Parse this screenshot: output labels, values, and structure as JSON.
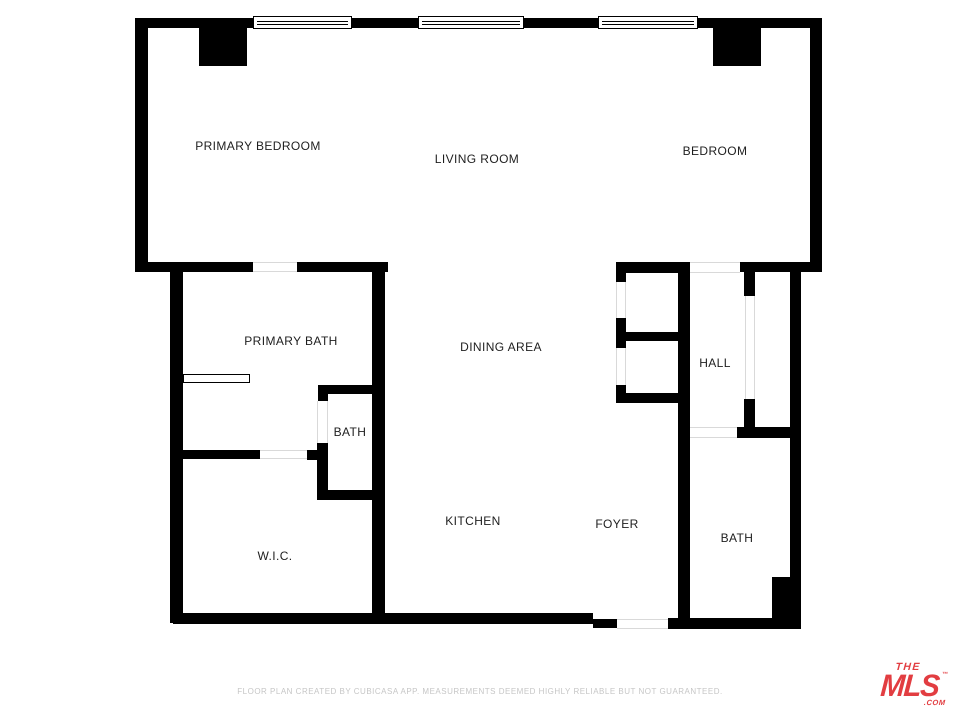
{
  "floor_plan": {
    "wall_color": "#000000",
    "label_color": "#1e1e1e",
    "opening_line_color": "#d9d9d9",
    "rooms": [
      {
        "name": "PRIMARY BEDROOM",
        "x": 258,
        "y": 146
      },
      {
        "name": "LIVING ROOM",
        "x": 477,
        "y": 159
      },
      {
        "name": "BEDROOM",
        "x": 715,
        "y": 151
      },
      {
        "name": "PRIMARY BATH",
        "x": 291,
        "y": 341
      },
      {
        "name": "DINING AREA",
        "x": 501,
        "y": 347
      },
      {
        "name": "HALL",
        "x": 715,
        "y": 363
      },
      {
        "name": "BATH",
        "x": 350,
        "y": 432
      },
      {
        "name": "W.I.C.",
        "x": 275,
        "y": 556
      },
      {
        "name": "KITCHEN",
        "x": 473,
        "y": 521
      },
      {
        "name": "FOYER",
        "x": 617,
        "y": 524
      },
      {
        "name": "BATH",
        "x": 737,
        "y": 538
      }
    ],
    "walls": [
      {
        "name": "top-wall-seg1",
        "x": 135,
        "y": 18,
        "w": 118,
        "h": 10
      },
      {
        "name": "top-wall-seg2",
        "x": 352,
        "y": 18,
        "w": 66,
        "h": 10
      },
      {
        "name": "top-wall-seg3",
        "x": 524,
        "y": 18,
        "w": 74,
        "h": 10
      },
      {
        "name": "top-wall-seg4",
        "x": 698,
        "y": 18,
        "w": 124,
        "h": 10
      },
      {
        "name": "left-outer-wall",
        "x": 135,
        "y": 18,
        "w": 13,
        "h": 254
      },
      {
        "name": "right-outer-wall",
        "x": 810,
        "y": 18,
        "w": 12,
        "h": 253
      },
      {
        "name": "pillar-primary-bedroom",
        "x": 199,
        "y": 28,
        "w": 48,
        "h": 38
      },
      {
        "name": "pillar-bedroom",
        "x": 713,
        "y": 28,
        "w": 48,
        "h": 38
      },
      {
        "name": "primary-bath-top-seg1",
        "x": 135,
        "y": 262,
        "w": 118,
        "h": 10
      },
      {
        "name": "primary-bath-top-seg2",
        "x": 297,
        "y": 262,
        "w": 91,
        "h": 10
      },
      {
        "name": "closet-top-wall",
        "x": 616,
        "y": 262,
        "w": 74,
        "h": 11
      },
      {
        "name": "bedroom-bottom-wall",
        "x": 740,
        "y": 262,
        "w": 82,
        "h": 10
      },
      {
        "name": "wic-left-wall",
        "x": 170,
        "y": 262,
        "w": 13,
        "h": 361
      },
      {
        "name": "central-vertical-wall",
        "x": 372,
        "y": 262,
        "w": 13,
        "h": 361
      },
      {
        "name": "mid-vertical-wall",
        "x": 678,
        "y": 262,
        "w": 12,
        "h": 361
      },
      {
        "name": "inner-right-wall",
        "x": 790,
        "y": 262,
        "w": 11,
        "h": 367
      },
      {
        "name": "primary-bath-bottom-seg",
        "x": 183,
        "y": 450,
        "w": 77,
        "h": 9
      },
      {
        "name": "primary-bath-bottom-stub",
        "x": 307,
        "y": 450,
        "w": 21,
        "h": 10
      },
      {
        "name": "small-bath-top-wall",
        "x": 318,
        "y": 385,
        "w": 67,
        "h": 9
      },
      {
        "name": "small-bath-top-jamb",
        "x": 318,
        "y": 385,
        "w": 10,
        "h": 16
      },
      {
        "name": "small-bath-left-wall",
        "x": 317,
        "y": 443,
        "w": 11,
        "h": 57
      },
      {
        "name": "small-bath-bottom-wall",
        "x": 317,
        "y": 490,
        "w": 68,
        "h": 10
      },
      {
        "name": "closet-left-seg1",
        "x": 616,
        "y": 262,
        "w": 10,
        "h": 20
      },
      {
        "name": "closet-left-seg2",
        "x": 616,
        "y": 318,
        "w": 10,
        "h": 30
      },
      {
        "name": "closet-left-seg3",
        "x": 616,
        "y": 385,
        "w": 10,
        "h": 18
      },
      {
        "name": "closet-divider-wall",
        "x": 620,
        "y": 332,
        "w": 70,
        "h": 9
      },
      {
        "name": "closet-bottom-wall",
        "x": 616,
        "y": 393,
        "w": 62,
        "h": 10
      },
      {
        "name": "hall-jamb-top",
        "x": 744,
        "y": 262,
        "w": 11,
        "h": 34
      },
      {
        "name": "hall-jamb-bottom",
        "x": 744,
        "y": 399,
        "w": 11,
        "h": 31
      },
      {
        "name": "bath-top-wall",
        "x": 737,
        "y": 427,
        "w": 64,
        "h": 11
      },
      {
        "name": "bottom-wall-left",
        "x": 173,
        "y": 613,
        "w": 420,
        "h": 11
      },
      {
        "name": "bottom-wall-step",
        "x": 593,
        "y": 619,
        "w": 24,
        "h": 9
      },
      {
        "name": "bottom-wall-right",
        "x": 668,
        "y": 618,
        "w": 133,
        "h": 11
      },
      {
        "name": "bath-plumbing-block",
        "x": 772,
        "y": 577,
        "w": 18,
        "h": 52
      }
    ],
    "windows": [
      {
        "name": "window-primary-bedroom",
        "x": 253,
        "y": 16,
        "w": 99,
        "h": 13
      },
      {
        "name": "window-living-room",
        "x": 418,
        "y": 16,
        "w": 106,
        "h": 13
      },
      {
        "name": "window-bedroom",
        "x": 598,
        "y": 16,
        "w": 100,
        "h": 13
      }
    ],
    "openings": [
      {
        "name": "door-primary-bath",
        "dir": "h",
        "x": 253,
        "y": 262,
        "w": 44,
        "h": 10
      },
      {
        "name": "door-wic",
        "dir": "h",
        "x": 260,
        "y": 450,
        "w": 47,
        "h": 9
      },
      {
        "name": "door-small-bath",
        "dir": "v",
        "x": 317,
        "y": 401,
        "w": 11,
        "h": 42
      },
      {
        "name": "door-closet-upper",
        "dir": "v",
        "x": 616,
        "y": 282,
        "w": 10,
        "h": 36
      },
      {
        "name": "door-closet-lower",
        "dir": "v",
        "x": 616,
        "y": 348,
        "w": 10,
        "h": 37
      },
      {
        "name": "opening-hall-closet",
        "dir": "v",
        "x": 745,
        "y": 296,
        "w": 10,
        "h": 103
      },
      {
        "name": "opening-living-hall",
        "dir": "h",
        "x": 690,
        "y": 262,
        "w": 50,
        "h": 11
      },
      {
        "name": "opening-hall-bath",
        "dir": "h",
        "x": 690,
        "y": 427,
        "w": 47,
        "h": 11
      },
      {
        "name": "entry-door-gap",
        "dir": "h",
        "x": 617,
        "y": 619,
        "w": 51,
        "h": 10
      }
    ],
    "fixtures": [
      {
        "name": "vanity",
        "x": 183,
        "y": 374,
        "w": 67,
        "h": 9
      }
    ]
  },
  "footer": {
    "disclaimer": "FLOOR PLAN CREATED BY CUBICASA APP. MEASUREMENTS DEEMED HIGHLY RELIABLE BUT NOT GUARANTEED."
  },
  "logo": {
    "the": "THE",
    "mls": "MLS",
    "tm": "™",
    "com": ".COM",
    "color": "#e23d41"
  }
}
